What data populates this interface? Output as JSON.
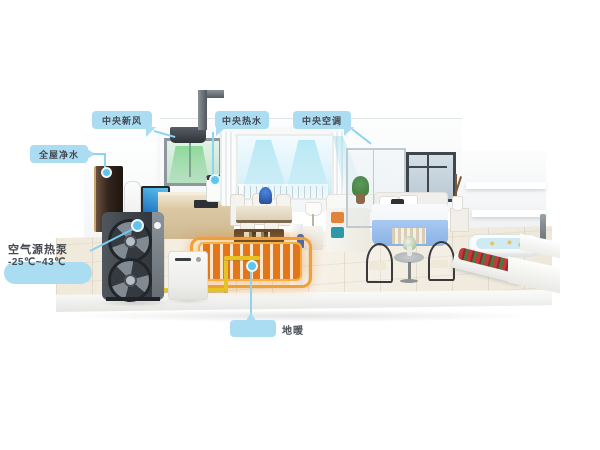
{
  "callouts": {
    "fresh_air": {
      "label": "中央新风"
    },
    "hot_water": {
      "label": "中央热水"
    },
    "air_conditioning": {
      "label": "中央空调"
    },
    "water_purification": {
      "label": "全屋净水"
    },
    "heat_pump": {
      "label_line1": "空气源热泵",
      "label_line2": "-25℃~43℃"
    },
    "floor_heating": {
      "label": "地暖"
    }
  },
  "colors": {
    "background": "#ffffff",
    "callout_bubble": "#aadcf2",
    "leader_line": "#8fd4ee",
    "label_text": "#44484f",
    "fresh_air_flow_green": "#4cc45f",
    "cool_air_flow_cyan": "#7ed7ea",
    "floor_heating_orange": "#e2761b",
    "water_pipe_yellow": "#e6c322",
    "heat_pump_body": "#3a3f45"
  }
}
